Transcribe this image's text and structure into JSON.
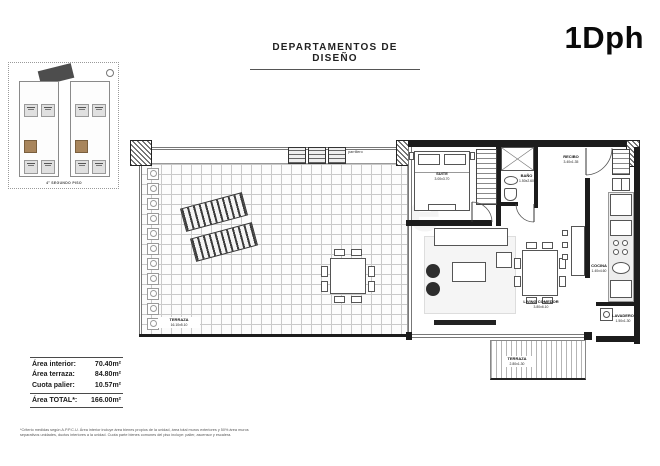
{
  "header": {
    "title": "DEPARTAMENTOS DE DISEÑO",
    "unit_code": "1Dph"
  },
  "keyplan": {
    "caption": "4° SEGUNDO PISO"
  },
  "watermark": "meikle",
  "plan": {
    "parrillero_label": "parrillero",
    "rooms": {
      "terraza_main": {
        "name": "TERRAZA",
        "dims": "16.10x5.10"
      },
      "suite": {
        "name": "SUITE",
        "dims": "3.00x3.70"
      },
      "bano": {
        "name": "BAÑO",
        "dims": "1.50x2.60"
      },
      "recibo": {
        "name": "RECIBO",
        "dims": "3.40x1.35"
      },
      "cocina": {
        "name": "COCINA",
        "dims": "1.40x4.60"
      },
      "lavadero": {
        "name": "LAVADERO",
        "dims": "1.50x1.30"
      },
      "living": {
        "name": "LIVING COMEDOR",
        "dims": "3.80x6.10"
      },
      "terraza_small": {
        "name": "TERRAZA",
        "dims": "2.80x1.30"
      }
    }
  },
  "areas": {
    "rows": [
      {
        "label": "Área interior:",
        "value": "70.40m²"
      },
      {
        "label": "Área terraza:",
        "value": "84.80m²"
      },
      {
        "label": "Cuota palier:",
        "value": "10.57m²"
      }
    ],
    "total": {
      "label": "Área TOTAL*:",
      "value": "166.00m²"
    }
  },
  "footnote": "*Criterio medidas según A.P.P.C.U. Área interior incluye área bienes propios de la unidad, área total muros exteriores y 50% área muros separativos unidades, ductos interiores a la unidad. Cuota parte bienes comunes del piso incluye: palier, ascensor y escalera.",
  "colors": {
    "highlight_tan": "#a8855c",
    "wall": "#1c1c1c",
    "deck_grid": "#c9c9c9"
  }
}
